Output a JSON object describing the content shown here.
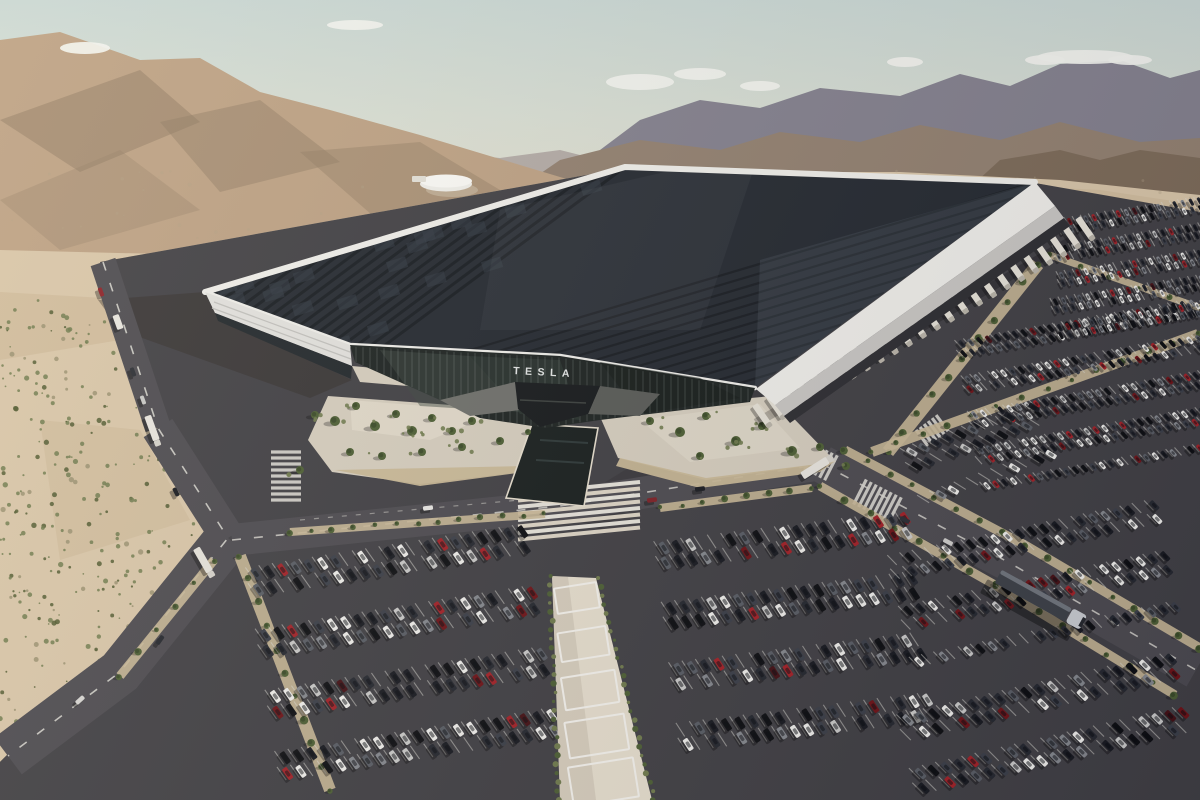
{
  "scene": {
    "title": "Aerial render of Tesla Gigafactory in the Nevada desert"
  },
  "factory": {
    "roof_lettering": "TESLA",
    "facade_logo": "TESLA",
    "dock_trailer_count": 24,
    "pergola_count": 5
  },
  "colors": {
    "mountain_far": "#83808d",
    "mountain_mid": "#92806f",
    "mountain_near_right": "#7c6a57",
    "mountain_left": "#bda183",
    "mountain_left_shadow": "#8f7a62",
    "far_ridge_pale": "#b3aba6",
    "cloud": "#f3f4ef",
    "desert": "#d9c6a8",
    "desert_patch": "#cbb694",
    "shrub_green": "#6f7a4c",
    "shrub_dark": "#50592f",
    "asphalt": "#403f43",
    "road": "#4c4a4f",
    "marking": "#dcdad2",
    "concrete": "#d6cebe",
    "concrete_bright": "#e6decd",
    "planting_bed": "#c9b896",
    "building_white": "#f0efea",
    "parapet_shade": "#c9c7c3",
    "solar_dark": "#23282f",
    "solar_seam": "#0e1115",
    "solar_sheen": "#8fa0b0",
    "glass": "#1c2220",
    "glass_reflection": "#3d4a42",
    "mullion": "#bac4be",
    "logo_white": "#e4e7e6",
    "roof_letter_white": "#f2f1ea",
    "trailer_white": "#e6e2d7",
    "tree_green": "#4c5e33",
    "tree_core": "#3a4a27",
    "pool_dark": "#171d1c",
    "canopy_grey": "#6e6f6a",
    "entrance_dark": "#15181a",
    "semi_trailer_grey": "#3c4046",
    "semi_cab_white": "#c9ccd0",
    "shadow": "#2d261f"
  },
  "car_palette": [
    {
      "hex": "#0d0e11",
      "w": 0.16
    },
    {
      "hex": "#17191f",
      "w": 0.14
    },
    {
      "hex": "#24272e",
      "w": 0.12
    },
    {
      "hex": "#3a3e47",
      "w": 0.08
    },
    {
      "hex": "#585c63",
      "w": 0.07
    },
    {
      "hex": "#84878c",
      "w": 0.07
    },
    {
      "hex": "#c9c9c7",
      "w": 0.08
    },
    {
      "hex": "#efeeea",
      "w": 0.16
    },
    {
      "hex": "#a22026",
      "w": 0.07
    },
    {
      "hex": "#6e1216",
      "w": 0.04
    },
    {
      "hex": "#441014",
      "w": 0.01
    }
  ]
}
